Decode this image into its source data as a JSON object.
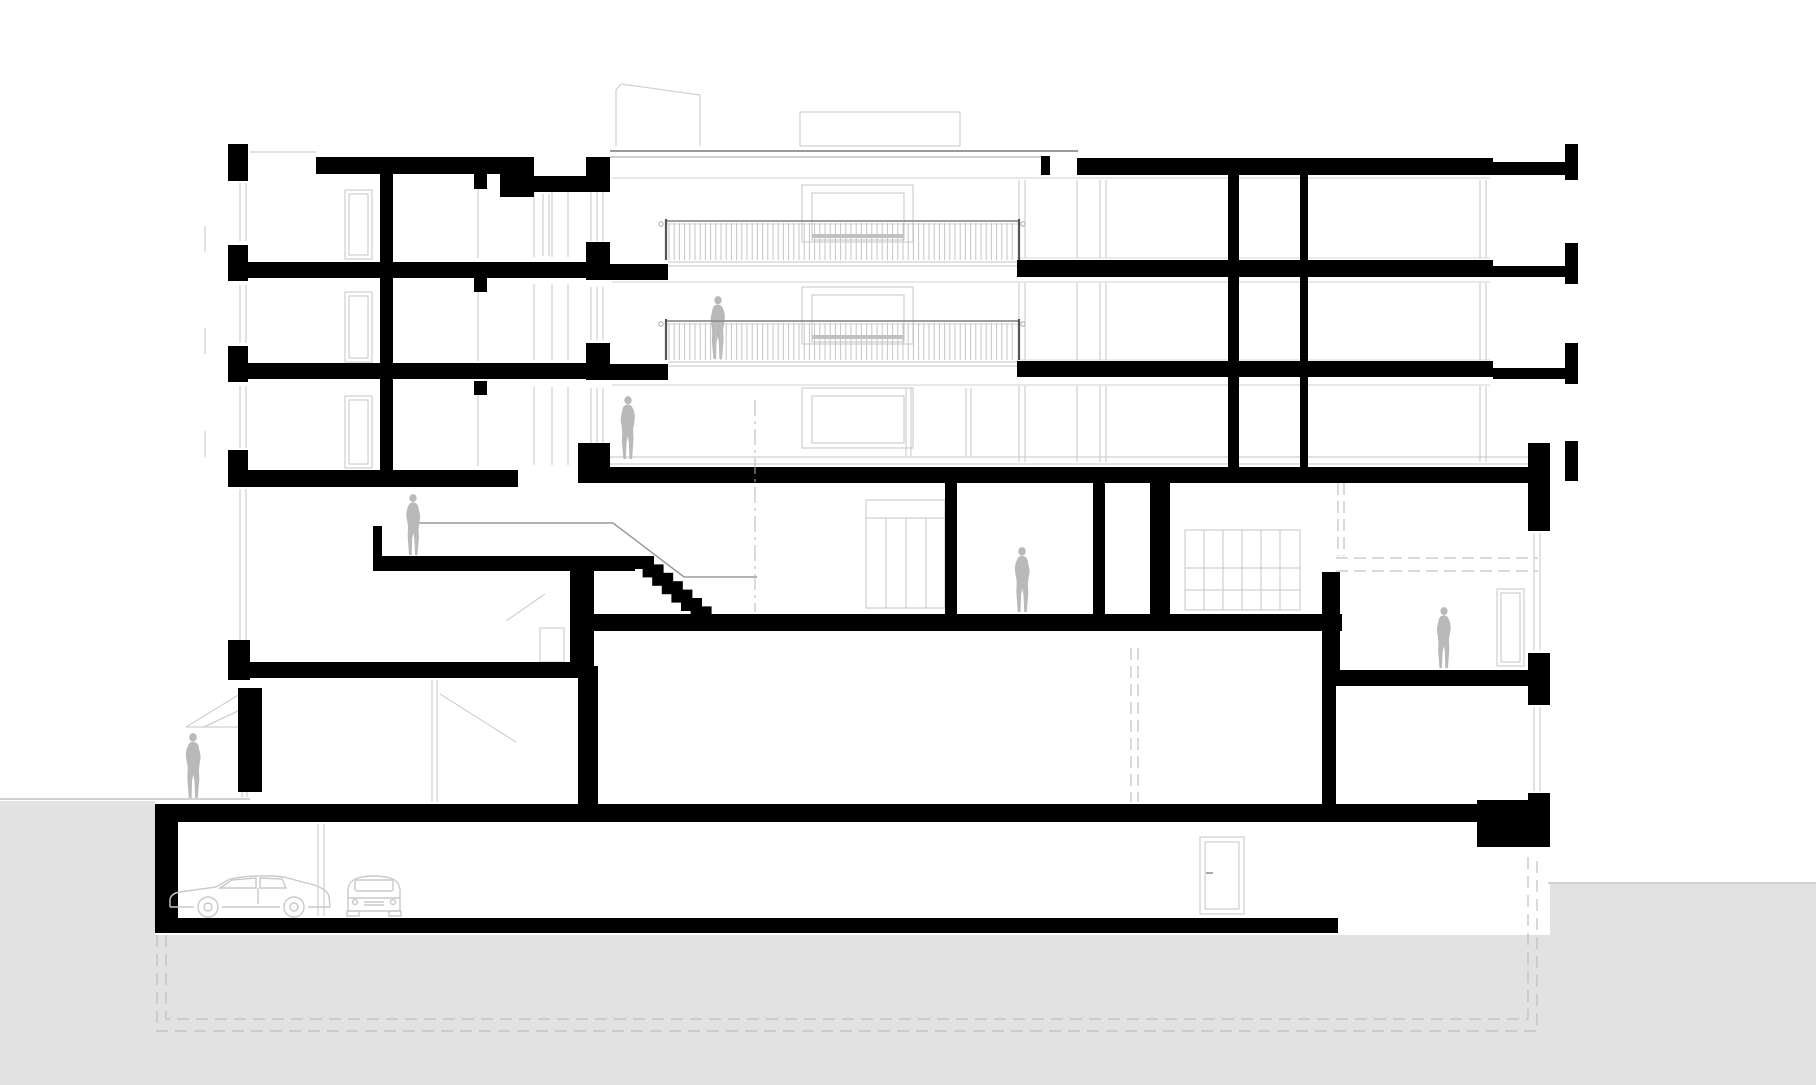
{
  "drawing": {
    "canvas": {
      "w": 1816,
      "h": 1085,
      "bg": "#ffffff"
    },
    "palette": {
      "poche": "#000000",
      "ground": "#e2e2e2",
      "figure": "#b9b9b9",
      "line": "#c6c6c6",
      "line_dark": "#9a9a9a",
      "dash": "#b5b5b5",
      "car": "#c9c9c9",
      "rail": "#8f8f8f",
      "baluster": "#c4c4c4"
    },
    "ground_poly": [
      [
        0,
        801
      ],
      [
        155,
        801
      ],
      [
        155,
        935
      ],
      [
        1550,
        935
      ],
      [
        1550,
        884
      ],
      [
        1816,
        884
      ],
      [
        1816,
        1085
      ],
      [
        0,
        1085
      ]
    ],
    "polylines": [
      {
        "n": "foundation-dashed-outer",
        "pts": [
          [
            157,
            935
          ],
          [
            157,
            1031
          ],
          [
            1537,
            1031
          ],
          [
            1537,
            856
          ]
        ],
        "c": "#b5b5b5",
        "w": 1,
        "dash": "12 7"
      },
      {
        "n": "foundation-dashed-inner",
        "pts": [
          [
            166,
            935
          ],
          [
            166,
            1019
          ],
          [
            1528,
            1019
          ],
          [
            1528,
            856
          ]
        ],
        "c": "#b5b5b5",
        "w": 1,
        "dash": "12 7"
      },
      {
        "n": "roof-bulkhead-sloped",
        "pts": [
          [
            616,
            146
          ],
          [
            616,
            90
          ],
          [
            621,
            84
          ],
          [
            700,
            95
          ],
          [
            700,
            146
          ]
        ],
        "c": "#d0d0d0",
        "w": 1.2
      },
      {
        "n": "stair-handrail",
        "pts": [
          [
            410,
            523
          ],
          [
            613,
            523
          ],
          [
            684,
            577
          ],
          [
            757,
            577
          ]
        ],
        "c": "#9a9a9a",
        "w": 1.5
      }
    ],
    "gray_lines": [
      [
        250,
        152,
        316,
        152
      ],
      [
        610,
        151,
        1078,
        151,
        2,
        "#9a9a9a"
      ],
      [
        610,
        157,
        1044,
        157,
        1.2,
        "#b2b2b2"
      ],
      [
        478,
        176,
        478,
        258
      ],
      [
        478,
        278,
        478,
        361
      ],
      [
        478,
        381,
        478,
        466
      ],
      [
        534,
        182,
        534,
        257
      ],
      [
        552,
        182,
        552,
        257
      ],
      [
        568,
        182,
        568,
        257
      ],
      [
        534,
        284,
        534,
        360
      ],
      [
        552,
        284,
        552,
        360
      ],
      [
        568,
        284,
        568,
        360
      ],
      [
        534,
        387,
        534,
        465
      ],
      [
        552,
        387,
        552,
        465
      ],
      [
        568,
        387,
        568,
        465
      ],
      [
        240,
        183,
        240,
        241
      ],
      [
        246,
        183,
        246,
        241
      ],
      [
        240,
        285,
        240,
        343
      ],
      [
        246,
        285,
        246,
        343
      ],
      [
        240,
        386,
        240,
        448
      ],
      [
        246,
        386,
        246,
        448
      ],
      [
        240,
        489,
        240,
        645
      ],
      [
        246,
        489,
        246,
        645
      ],
      [
        242,
        692,
        242,
        792
      ],
      [
        247,
        692,
        247,
        792
      ],
      [
        205,
        226,
        205,
        252
      ],
      [
        205,
        328,
        205,
        354
      ],
      [
        205,
        431,
        205,
        457
      ],
      [
        543,
        194,
        543,
        256
      ],
      [
        549,
        194,
        549,
        256
      ],
      [
        591,
        182,
        591,
        241
      ],
      [
        597,
        182,
        597,
        241
      ],
      [
        603,
        182,
        603,
        241
      ],
      [
        591,
        287,
        591,
        340
      ],
      [
        597,
        287,
        597,
        340
      ],
      [
        603,
        287,
        603,
        340
      ],
      [
        591,
        388,
        591,
        443
      ],
      [
        597,
        388,
        597,
        443
      ],
      [
        603,
        388,
        603,
        443
      ],
      [
        612,
        178,
        1490,
        178,
        1,
        "#d2d2d2"
      ],
      [
        612,
        282,
        1490,
        282,
        1,
        "#d2d2d2"
      ],
      [
        612,
        385,
        1490,
        385,
        1,
        "#d2d2d2"
      ],
      [
        668,
        262,
        1017,
        262
      ],
      [
        668,
        266,
        1017,
        266
      ],
      [
        668,
        362,
        1017,
        362
      ],
      [
        668,
        366,
        1017,
        366
      ],
      [
        610,
        457,
        1528,
        457
      ],
      [
        610,
        464,
        1528,
        464
      ],
      [
        906,
        388,
        906,
        456
      ],
      [
        911,
        388,
        911,
        456
      ],
      [
        966,
        388,
        966,
        456
      ],
      [
        971,
        388,
        971,
        456
      ],
      [
        1019,
        180,
        1019,
        258
      ],
      [
        1019,
        283,
        1019,
        360
      ],
      [
        1019,
        386,
        1019,
        462
      ],
      [
        1025,
        180,
        1025,
        258
      ],
      [
        1025,
        283,
        1025,
        360
      ],
      [
        1025,
        386,
        1025,
        462
      ],
      [
        1077,
        180,
        1077,
        258
      ],
      [
        1077,
        283,
        1077,
        360
      ],
      [
        1077,
        386,
        1077,
        462
      ],
      [
        1100,
        180,
        1100,
        258
      ],
      [
        1100,
        283,
        1100,
        360
      ],
      [
        1100,
        386,
        1100,
        462
      ],
      [
        1106,
        180,
        1106,
        258
      ],
      [
        1106,
        283,
        1106,
        360
      ],
      [
        1106,
        386,
        1106,
        462
      ],
      [
        1017,
        258,
        1490,
        258,
        1,
        "#d8d8d8"
      ],
      [
        1017,
        360,
        1490,
        360,
        1,
        "#d8d8d8"
      ],
      [
        1480,
        180,
        1480,
        258
      ],
      [
        1486,
        180,
        1486,
        258
      ],
      [
        1480,
        283,
        1480,
        360
      ],
      [
        1486,
        283,
        1486,
        360
      ],
      [
        1480,
        386,
        1480,
        462
      ],
      [
        1486,
        386,
        1486,
        462
      ],
      [
        1534,
        533,
        1534,
        650
      ],
      [
        1540,
        533,
        1540,
        650
      ],
      [
        1534,
        707,
        1534,
        791
      ],
      [
        1540,
        707,
        1540,
        791
      ],
      [
        545,
        594,
        506,
        621
      ],
      [
        440,
        694,
        516,
        742
      ],
      [
        432,
        680,
        432,
        802
      ],
      [
        437,
        680,
        437,
        802
      ],
      [
        186,
        727,
        240,
        727
      ],
      [
        240,
        694,
        186,
        727
      ],
      [
        240,
        710,
        204,
        727
      ],
      [
        242,
        690,
        242,
        797
      ],
      [
        247,
        690,
        247,
        797
      ],
      [
        318,
        824,
        318,
        916
      ],
      [
        324,
        824,
        324,
        916
      ],
      [
        1206,
        873,
        1213,
        873,
        2,
        "#aaaaaa"
      ],
      [
        866,
        518,
        945,
        518
      ],
      [
        886,
        518,
        886,
        608
      ],
      [
        906,
        518,
        906,
        608
      ],
      [
        926,
        518,
        926,
        608
      ],
      [
        1185,
        568,
        1300,
        568
      ],
      [
        1185,
        590,
        1300,
        590
      ],
      [
        1204,
        530,
        1204,
        610
      ],
      [
        1223,
        530,
        1223,
        610
      ],
      [
        1242,
        530,
        1242,
        610
      ],
      [
        1261,
        530,
        1261,
        610
      ],
      [
        1280,
        530,
        1280,
        610
      ],
      [
        0,
        799,
        250,
        799,
        1,
        "#a5a5a5"
      ],
      [
        1548,
        883,
        1816,
        883,
        1,
        "#a5a5a5"
      ],
      [
        812,
        236,
        904,
        236,
        4,
        "#c0c0c0"
      ],
      [
        812,
        337,
        904,
        337,
        4,
        "#c0c0c0"
      ]
    ],
    "light_rects": [
      {
        "n": "door-elevation",
        "x": 345,
        "y": 190,
        "w": 27,
        "h": 69,
        "inset": 4
      },
      {
        "n": "door-elevation",
        "x": 345,
        "y": 292,
        "w": 27,
        "h": 70,
        "inset": 4
      },
      {
        "n": "door-elevation",
        "x": 345,
        "y": 396,
        "w": 27,
        "h": 72,
        "inset": 4
      },
      {
        "n": "window-box",
        "x": 802,
        "y": 185,
        "w": 111,
        "h": 57
      },
      {
        "n": "window-box-inner",
        "x": 812,
        "y": 193,
        "w": 92,
        "h": 47
      },
      {
        "n": "window-box",
        "x": 802,
        "y": 287,
        "w": 111,
        "h": 57
      },
      {
        "n": "window-box-inner",
        "x": 812,
        "y": 295,
        "w": 92,
        "h": 47
      },
      {
        "n": "window-box",
        "x": 802,
        "y": 388,
        "w": 111,
        "h": 60
      },
      {
        "n": "window-box-inner",
        "x": 812,
        "y": 396,
        "w": 92,
        "h": 47
      },
      {
        "n": "roof-bulkhead-box",
        "x": 800,
        "y": 112,
        "w": 160,
        "h": 34
      },
      {
        "n": "closet-elevation",
        "x": 866,
        "y": 500,
        "w": 79,
        "h": 108
      },
      {
        "n": "cabinet-elevation",
        "x": 1185,
        "y": 530,
        "w": 115,
        "h": 80
      },
      {
        "n": "cabinet-low",
        "x": 540,
        "y": 628,
        "w": 24,
        "h": 34
      },
      {
        "n": "basement-door",
        "x": 1200,
        "y": 837,
        "w": 44,
        "h": 77,
        "inset": 5
      },
      {
        "n": "garden-room-door",
        "x": 1497,
        "y": 589,
        "w": 27,
        "h": 77,
        "inset": 4
      }
    ],
    "black_rects": [
      [
        228,
        144,
        20,
        37,
        "facade-pier"
      ],
      [
        228,
        245,
        20,
        36,
        "facade-pier"
      ],
      [
        228,
        346,
        20,
        36,
        "facade-pier"
      ],
      [
        228,
        450,
        20,
        37,
        "facade-pier"
      ],
      [
        228,
        640,
        22,
        40,
        "facade-pier"
      ],
      [
        238,
        688,
        24,
        104,
        "exterior-wall-lower-left"
      ],
      [
        316,
        157,
        206,
        17,
        "roof-slab-left"
      ],
      [
        500,
        157,
        34,
        40,
        "roof-parapet-step"
      ],
      [
        534,
        176,
        76,
        16,
        "roof-slab-thin"
      ],
      [
        586,
        157,
        24,
        33,
        "party-pier-roof"
      ],
      [
        586,
        242,
        24,
        38,
        "party-pier-f3"
      ],
      [
        586,
        343,
        24,
        37,
        "party-pier-f2"
      ],
      [
        578,
        443,
        32,
        40,
        "party-pier-f1"
      ],
      [
        248,
        262,
        344,
        16,
        "floor3-slab-left"
      ],
      [
        248,
        363,
        344,
        16,
        "floor2-slab-left"
      ],
      [
        240,
        470,
        278,
        17,
        "floor1-slab-left"
      ],
      [
        380,
        174,
        13,
        300,
        "interior-wall-left"
      ],
      [
        474,
        174,
        13,
        15,
        "slab-stub"
      ],
      [
        474,
        278,
        13,
        14,
        "slab-stub"
      ],
      [
        474,
        381,
        13,
        14,
        "slab-stub"
      ],
      [
        586,
        264,
        82,
        16,
        "terrace-slab-upper"
      ],
      [
        586,
        364,
        82,
        16,
        "terrace-slab-lower"
      ],
      [
        228,
        662,
        366,
        16,
        "lower-slab-left"
      ],
      [
        373,
        556,
        262,
        15,
        "mezzanine-landing-slab"
      ],
      [
        373,
        526,
        9,
        32,
        "landing-guard-wall"
      ],
      [
        570,
        571,
        24,
        97,
        "wall-under-landing"
      ],
      [
        578,
        666,
        20,
        140,
        "wall-lower-left"
      ],
      [
        578,
        614,
        764,
        17,
        "hall-floor-slab"
      ],
      [
        1041,
        156,
        9,
        19,
        "roof-upstand"
      ],
      [
        1077,
        158,
        416,
        17,
        "roof-slab-right"
      ],
      [
        1493,
        162,
        72,
        13,
        "roof-slab-balcony"
      ],
      [
        1565,
        144,
        13,
        36,
        "roof-parapet-end"
      ],
      [
        1017,
        260,
        476,
        17,
        "floor3-slab-right"
      ],
      [
        1493,
        266,
        72,
        11,
        "floor3-balcony-ext"
      ],
      [
        1565,
        243,
        13,
        41,
        "floor3-slab-end"
      ],
      [
        1017,
        361,
        476,
        16,
        "floor2-slab-right"
      ],
      [
        1493,
        368,
        72,
        11,
        "floor2-balcony-ext"
      ],
      [
        1565,
        343,
        13,
        41,
        "floor2-slab-end"
      ],
      [
        594,
        467,
        934,
        16,
        "level4-ceiling-slab"
      ],
      [
        1565,
        441,
        13,
        40,
        "floor1-slab-end"
      ],
      [
        1228,
        174,
        11,
        293,
        "right-wing-wall-a"
      ],
      [
        1300,
        174,
        8,
        293,
        "right-wing-wall-b"
      ],
      [
        1528,
        443,
        22,
        88,
        "corner-pier-upper"
      ],
      [
        945,
        483,
        12,
        132,
        "level4-wall-a"
      ],
      [
        1093,
        483,
        12,
        132,
        "level4-wall-b"
      ],
      [
        1150,
        483,
        20,
        132,
        "level4-wall-c"
      ],
      [
        1322,
        572,
        18,
        100,
        "step-down-wall"
      ],
      [
        1322,
        670,
        224,
        16,
        "garden-room-slab"
      ],
      [
        1322,
        686,
        14,
        118,
        "wall-under-garden-slab"
      ],
      [
        1528,
        653,
        22,
        52,
        "corner-pier-mid"
      ],
      [
        1528,
        793,
        22,
        54,
        "corner-pier-low"
      ],
      [
        155,
        804,
        1322,
        18,
        "garage-ceiling-slab"
      ],
      [
        1477,
        800,
        73,
        47,
        "footing-step-block"
      ],
      [
        155,
        804,
        23,
        129,
        "garage-west-wall"
      ],
      [
        155,
        918,
        1183,
        15,
        "garage-floor-slab"
      ]
    ],
    "stair": {
      "x": 633,
      "y": 556,
      "n": 7,
      "dx": 9.6,
      "dy": 8.4,
      "w": 21,
      "h": 13
    },
    "railings": [
      {
        "n": "balcony-railing-upper",
        "x": 666,
        "w": 353,
        "rail_y": 221,
        "bot": 260
      },
      {
        "n": "balcony-railing-lower",
        "x": 666,
        "w": 353,
        "rail_y": 321,
        "bot": 360
      }
    ],
    "railing_markers": [
      [
        661,
        224
      ],
      [
        1023,
        224
      ],
      [
        661,
        324
      ],
      [
        1023,
        324
      ]
    ],
    "figures": [
      {
        "n": "person-on-balcony",
        "x": 718,
        "y": 360,
        "h": 64,
        "flip": false
      },
      {
        "n": "person-ground-floor-middle",
        "x": 628,
        "y": 460,
        "h": 64,
        "flip": false
      },
      {
        "n": "person-on-landing",
        "x": 413,
        "y": 556,
        "h": 62,
        "flip": true
      },
      {
        "n": "person-level4-room",
        "x": 1022,
        "y": 613,
        "h": 66,
        "flip": true
      },
      {
        "n": "person-garden-room",
        "x": 1444,
        "y": 669,
        "h": 62,
        "flip": false
      },
      {
        "n": "person-outside-left",
        "x": 193,
        "y": 799,
        "h": 66,
        "flip": true
      }
    ],
    "cars": [
      {
        "n": "car-side-view",
        "type": "side",
        "x": 166,
        "y": 866,
        "w": 168,
        "h": 53
      },
      {
        "n": "car-front-view",
        "type": "front",
        "x": 342,
        "y": 867,
        "w": 64,
        "h": 52
      }
    ],
    "dash_lines": [
      [
        755,
        400,
        755,
        612,
        "16 5 3 5"
      ],
      [
        1131,
        648,
        1131,
        802,
        "12 6"
      ],
      [
        1138,
        648,
        1138,
        802,
        "12 6"
      ],
      [
        1338,
        483,
        1338,
        556,
        "12 6"
      ],
      [
        1344,
        483,
        1344,
        556,
        "12 6"
      ],
      [
        1336,
        558,
        1538,
        558,
        "12 6"
      ],
      [
        1336,
        571,
        1538,
        571,
        "12 6"
      ]
    ]
  }
}
